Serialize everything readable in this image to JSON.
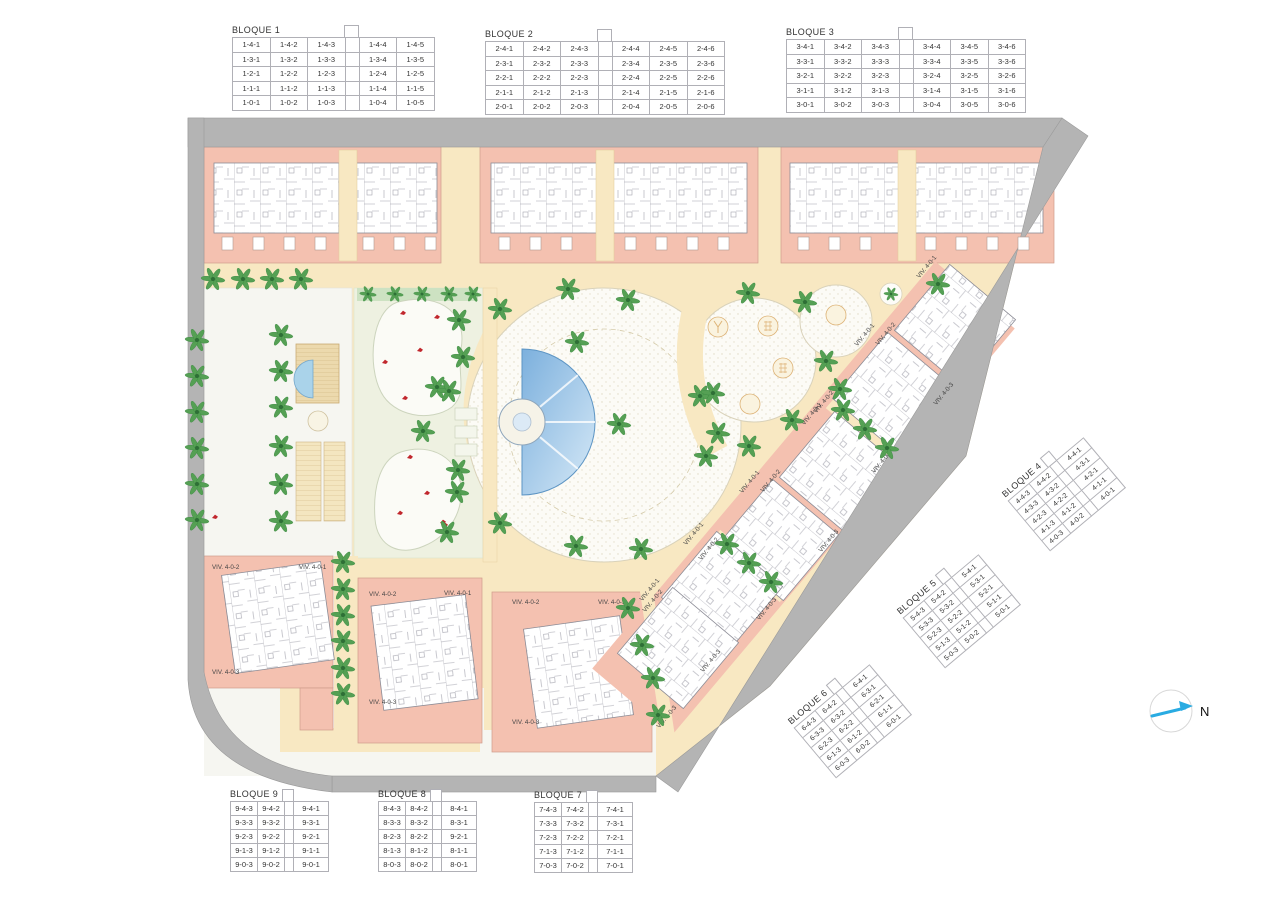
{
  "plan": {
    "north_label": "N",
    "colors": {
      "path_cream": "#f8e8c2",
      "building_pink": "#f4c1b0",
      "road_gray": "#b4b4b4",
      "pool_blue_dark": "#7cb0dd",
      "pool_blue_light": "#d6e9f7",
      "palm_green": "#55a054",
      "lawn_white": "#f6f6f1",
      "kidney_green": "#eef1e1",
      "north_arrow_cyan": "#29abe2",
      "red_mark": "#c1272d"
    },
    "viv_labels": [
      {
        "t": "VIV. 4-0-2",
        "x": 212,
        "y": 569,
        "r": 0,
        "a": "start"
      },
      {
        "t": "VIV. 4-0-1",
        "x": 299,
        "y": 569,
        "r": 0,
        "a": "start"
      },
      {
        "t": "VIV. 4-0-3",
        "x": 212,
        "y": 674,
        "r": 0,
        "a": "start"
      },
      {
        "t": "VIV. 4-0-2",
        "x": 369,
        "y": 596,
        "r": 0,
        "a": "start"
      },
      {
        "t": "VIV. 4-0-1",
        "x": 444,
        "y": 595,
        "r": 0,
        "a": "start"
      },
      {
        "t": "VIV. 4-0-3",
        "x": 369,
        "y": 704,
        "r": 0,
        "a": "start"
      },
      {
        "t": "VIV. 4-0-2",
        "x": 512,
        "y": 604,
        "r": 0,
        "a": "start"
      },
      {
        "t": "VIV. 4-0-1",
        "x": 598,
        "y": 604,
        "r": 0,
        "a": "start"
      },
      {
        "t": "VIV. 4-0-3",
        "x": 512,
        "y": 724,
        "r": 0,
        "a": "start"
      },
      {
        "t": "VIV. 4-0-1",
        "x": 928,
        "y": 268,
        "r": -50,
        "a": "middle"
      },
      {
        "t": "VIV. 4-0-2",
        "x": 887,
        "y": 335,
        "r": -50,
        "a": "middle"
      },
      {
        "t": "VIV. 4-0-3",
        "x": 945,
        "y": 395,
        "r": -50,
        "a": "middle"
      },
      {
        "t": "VIV. 4-0-1",
        "x": 866,
        "y": 336,
        "r": -50,
        "a": "middle"
      },
      {
        "t": "VIV. 4-0-2",
        "x": 825,
        "y": 403,
        "r": -50,
        "a": "middle"
      },
      {
        "t": "VIV. 4-0-3",
        "x": 883,
        "y": 463,
        "r": -50,
        "a": "middle"
      },
      {
        "t": "VIV. 4-0-1",
        "x": 813,
        "y": 415,
        "r": -50,
        "a": "middle"
      },
      {
        "t": "VIV. 4-0-2",
        "x": 772,
        "y": 482,
        "r": -50,
        "a": "middle"
      },
      {
        "t": "VIV. 4-0-3",
        "x": 830,
        "y": 542,
        "r": -50,
        "a": "middle"
      },
      {
        "t": "VIV. 4-0-1",
        "x": 751,
        "y": 483,
        "r": -50,
        "a": "middle"
      },
      {
        "t": "VIV. 4-0-2",
        "x": 710,
        "y": 550,
        "r": -50,
        "a": "middle"
      },
      {
        "t": "VIV. 4-0-3",
        "x": 768,
        "y": 610,
        "r": -50,
        "a": "middle"
      },
      {
        "t": "VIV. 4-0-1",
        "x": 695,
        "y": 535,
        "r": -50,
        "a": "middle"
      },
      {
        "t": "VIV. 4-0-2",
        "x": 654,
        "y": 602,
        "r": -50,
        "a": "middle"
      },
      {
        "t": "VIV. 4-0-3",
        "x": 712,
        "y": 662,
        "r": -50,
        "a": "middle"
      },
      {
        "t": "VIV. 4-0-1",
        "x": 651,
        "y": 591,
        "r": -50,
        "a": "middle"
      },
      {
        "t": "VIV. 4-0-3",
        "x": 668,
        "y": 718,
        "r": -50,
        "a": "middle"
      }
    ],
    "palms": [
      [
        197,
        340
      ],
      [
        197,
        376
      ],
      [
        197,
        412
      ],
      [
        197,
        448
      ],
      [
        197,
        484
      ],
      [
        197,
        520
      ],
      [
        213,
        279
      ],
      [
        243,
        279
      ],
      [
        272,
        279
      ],
      [
        301,
        279
      ],
      [
        281,
        335
      ],
      [
        281,
        371
      ],
      [
        281,
        407
      ],
      [
        281,
        446
      ],
      [
        281,
        484
      ],
      [
        281,
        521
      ],
      [
        343,
        562
      ],
      [
        343,
        589
      ],
      [
        343,
        615
      ],
      [
        343,
        641
      ],
      [
        343,
        668
      ],
      [
        343,
        694
      ],
      [
        368,
        294,
        0.7
      ],
      [
        395,
        294,
        0.7
      ],
      [
        422,
        294,
        0.7
      ],
      [
        449,
        294,
        0.7
      ],
      [
        473,
        294,
        0.7
      ],
      [
        459,
        320
      ],
      [
        437,
        387
      ],
      [
        423,
        431
      ],
      [
        458,
        470
      ],
      [
        447,
        532
      ],
      [
        568,
        289
      ],
      [
        628,
        300
      ],
      [
        500,
        309
      ],
      [
        463,
        357
      ],
      [
        449,
        391
      ],
      [
        577,
        342
      ],
      [
        619,
        424
      ],
      [
        700,
        396
      ],
      [
        706,
        456
      ],
      [
        457,
        492
      ],
      [
        500,
        523
      ],
      [
        576,
        546
      ],
      [
        641,
        549
      ],
      [
        748,
        293
      ],
      [
        805,
        302
      ],
      [
        713,
        393
      ],
      [
        718,
        433
      ],
      [
        749,
        446
      ],
      [
        792,
        420
      ],
      [
        840,
        389
      ],
      [
        826,
        361
      ],
      [
        891,
        294,
        0.6
      ],
      [
        843,
        410
      ],
      [
        865,
        429
      ],
      [
        887,
        448
      ],
      [
        727,
        544
      ],
      [
        749,
        563
      ],
      [
        771,
        582
      ],
      [
        628,
        608
      ],
      [
        642,
        645
      ],
      [
        653,
        678
      ],
      [
        658,
        715
      ],
      [
        938,
        284
      ]
    ],
    "red_marks": [
      [
        403,
        313
      ],
      [
        437,
        317
      ],
      [
        420,
        350
      ],
      [
        385,
        362
      ],
      [
        405,
        398
      ],
      [
        410,
        457
      ],
      [
        427,
        493
      ],
      [
        400,
        513
      ],
      [
        445,
        525
      ],
      [
        215,
        517
      ],
      [
        443,
        522
      ]
    ],
    "playground": [
      {
        "x": 718,
        "y": 327,
        "k": "y"
      },
      {
        "x": 768,
        "y": 326,
        "k": "grid"
      },
      {
        "x": 783,
        "y": 368,
        "k": "grid"
      },
      {
        "x": 750,
        "y": 404,
        "k": "plain"
      },
      {
        "x": 836,
        "y": 315,
        "k": "plain"
      }
    ],
    "sunbeds": [
      [
        455,
        408
      ],
      [
        455,
        426
      ],
      [
        455,
        444
      ]
    ],
    "terraces": [
      {
        "y": 237,
        "xs": [
          222,
          253,
          284,
          315,
          363,
          394,
          425
        ]
      },
      {
        "y": 237,
        "xs": [
          499,
          530,
          561,
          625,
          656,
          687,
          718
        ]
      },
      {
        "y": 237,
        "xs": [
          798,
          829,
          860,
          925,
          956,
          987,
          1018
        ]
      }
    ]
  },
  "tables": {
    "top": [
      {
        "title": "BLOQUE 1",
        "kind": "wide",
        "rows": [
          [
            "1-4-1",
            "1-4-2",
            "1-4-3",
            "",
            "1-4-4",
            "1-4-5"
          ],
          [
            "1-3-1",
            "1-3-2",
            "1-3-3",
            "",
            "1-3-4",
            "1-3-5"
          ],
          [
            "1-2-1",
            "1-2-2",
            "1-2-3",
            "",
            "1-2-4",
            "1-2-5"
          ],
          [
            "1-1-1",
            "1-1-2",
            "1-1-3",
            "",
            "1-1-4",
            "1-1-5"
          ],
          [
            "1-0-1",
            "1-0-2",
            "1-0-3",
            "",
            "1-0-4",
            "1-0-5"
          ]
        ]
      },
      {
        "title": "BLOQUE 2",
        "kind": "wide",
        "rows": [
          [
            "2-4-1",
            "2-4-2",
            "2-4-3",
            "",
            "2-4-4",
            "2-4-5",
            "2-4-6"
          ],
          [
            "2-3-1",
            "2-3-2",
            "2-3-3",
            "",
            "2-3-4",
            "2-3-5",
            "2-3-6"
          ],
          [
            "2-2-1",
            "2-2-2",
            "2-2-3",
            "",
            "2-2-4",
            "2-2-5",
            "2-2-6"
          ],
          [
            "2-1-1",
            "2-1-2",
            "2-1-3",
            "",
            "2-1-4",
            "2-1-5",
            "2-1-6"
          ],
          [
            "2-0-1",
            "2-0-2",
            "2-0-3",
            "",
            "2-0-4",
            "2-0-5",
            "2-0-6"
          ]
        ]
      },
      {
        "title": "BLOQUE 3",
        "kind": "wide",
        "rows": [
          [
            "3-4-1",
            "3-4-2",
            "3-4-3",
            "",
            "3-4-4",
            "3-4-5",
            "3-4-6"
          ],
          [
            "3-3-1",
            "3-3-2",
            "3-3-3",
            "",
            "3-3-4",
            "3-3-5",
            "3-3-6"
          ],
          [
            "3-2-1",
            "3-2-2",
            "3-2-3",
            "",
            "3-2-4",
            "3-2-5",
            "3-2-6"
          ],
          [
            "3-1-1",
            "3-1-2",
            "3-1-3",
            "",
            "3-1-4",
            "3-1-5",
            "3-1-6"
          ],
          [
            "3-0-1",
            "3-0-2",
            "3-0-3",
            "",
            "3-0-4",
            "3-0-5",
            "3-0-6"
          ]
        ]
      }
    ],
    "diagonal": [
      {
        "title": "BLOQUE 4",
        "kind": "narrow",
        "rows": [
          [
            "4-4-3",
            "4-4-2",
            "",
            "4-4-1"
          ],
          [
            "4-3-3",
            "4-3-2",
            "",
            "4-3-1"
          ],
          [
            "4-2-3",
            "4-2-2",
            "",
            "4-2-1"
          ],
          [
            "4-1-3",
            "4-1-2",
            "",
            "4-1-1"
          ],
          [
            "4-0-3",
            "4-0-2",
            "",
            "4-0-1"
          ]
        ]
      },
      {
        "title": "BLOQUE 5",
        "kind": "narrow",
        "rows": [
          [
            "5-4-3",
            "5-4-2",
            "",
            "5-4-1"
          ],
          [
            "5-3-3",
            "5-3-2",
            "",
            "5-3-1"
          ],
          [
            "5-2-3",
            "5-2-2",
            "",
            "5-2-1"
          ],
          [
            "5-1-3",
            "5-1-2",
            "",
            "5-1-1"
          ],
          [
            "5-0-3",
            "5-0-2",
            "",
            "5-0-1"
          ]
        ]
      },
      {
        "title": "BLOQUE 6",
        "kind": "narrow",
        "rows": [
          [
            "6-4-3",
            "6-4-2",
            "",
            "6-4-1"
          ],
          [
            "6-3-3",
            "6-3-2",
            "",
            "6-3-1"
          ],
          [
            "6-2-3",
            "6-2-2",
            "",
            "6-2-1"
          ],
          [
            "6-1-3",
            "6-1-2",
            "",
            "6-1-1"
          ],
          [
            "6-0-3",
            "6-0-2",
            "",
            "6-0-1"
          ]
        ]
      }
    ],
    "bottom": [
      {
        "title": "BLOQUE 9",
        "kind": "narrow",
        "rows": [
          [
            "9-4-3",
            "9-4-2",
            "",
            "9-4-1"
          ],
          [
            "9-3-3",
            "9-3-2",
            "",
            "9-3-1"
          ],
          [
            "9-2-3",
            "9-2-2",
            "",
            "9-2-1"
          ],
          [
            "9-1-3",
            "9-1-2",
            "",
            "9-1-1"
          ],
          [
            "9-0-3",
            "9-0-2",
            "",
            "9-0-1"
          ]
        ]
      },
      {
        "title": "BLOQUE 8",
        "kind": "narrow",
        "rows": [
          [
            "8-4-3",
            "8-4-2",
            "",
            "8-4-1"
          ],
          [
            "8-3-3",
            "8-3-2",
            "",
            "8-3-1"
          ],
          [
            "8-2-3",
            "8-2-2",
            "",
            "9-2-1"
          ],
          [
            "8-1-3",
            "8-1-2",
            "",
            "8-1-1"
          ],
          [
            "8-0-3",
            "8-0-2",
            "",
            "8-0-1"
          ]
        ]
      },
      {
        "title": "BLOQUE 7",
        "kind": "narrow",
        "rows": [
          [
            "7-4-3",
            "7-4-2",
            "",
            "7-4-1"
          ],
          [
            "7-3-3",
            "7-3-2",
            "",
            "7-3-1"
          ],
          [
            "7-2-3",
            "7-2-2",
            "",
            "7-2-1"
          ],
          [
            "7-1-3",
            "7-1-2",
            "",
            "7-1-1"
          ],
          [
            "7-0-3",
            "7-0-2",
            "",
            "7-0-1"
          ]
        ]
      }
    ]
  }
}
